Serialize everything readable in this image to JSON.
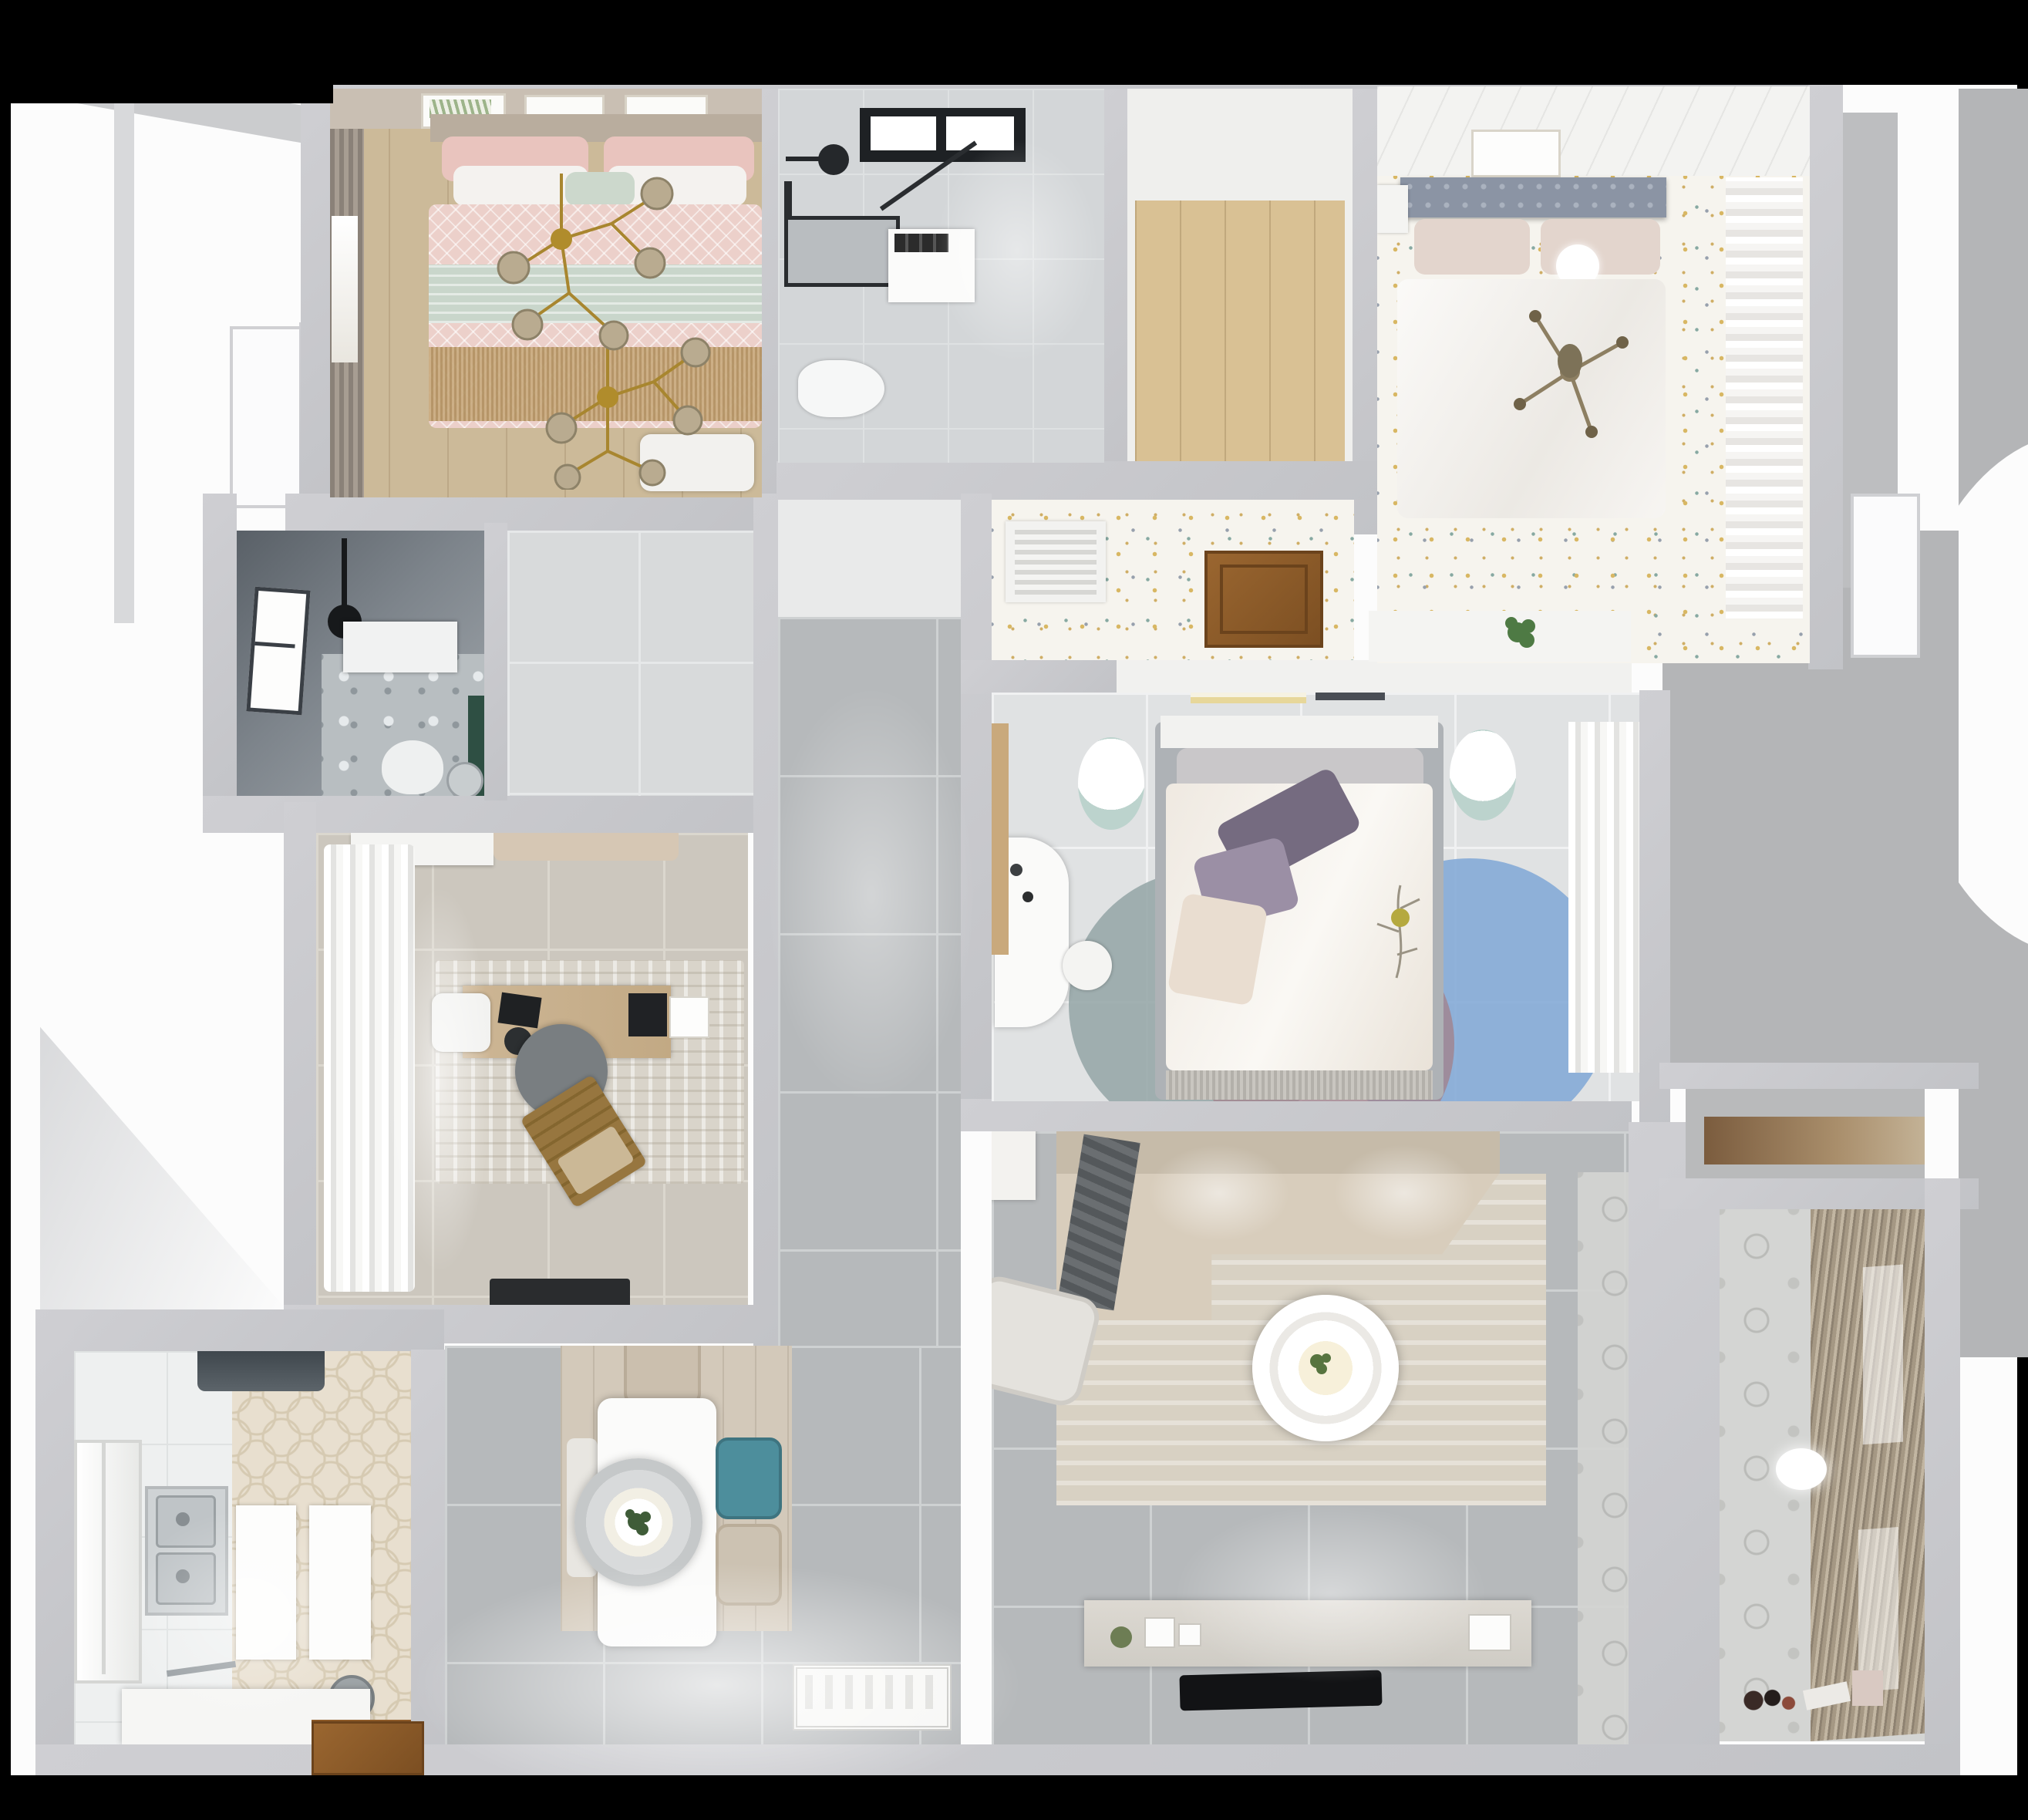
{
  "scene": {
    "title": "Apartment 3D floor plan – top-down render",
    "view": "top-down",
    "background": "#000000"
  },
  "palette": {
    "wall_gray": "#c6c7ca",
    "hall_tile": "#b6b9bb",
    "bedroom3_tile": "#e0e2e3",
    "study_tile": "#ccc7be",
    "kitchen_hex": "#e8dfcf",
    "dotted_floor": "#f6f4ee",
    "wood_floor": "#ccba99",
    "pink_bedding": "#ecd0ca",
    "mint_throw": "#c9d6cb",
    "gold_chandelier": "#a8862f",
    "teal_chair": "#4d8e9c",
    "rug_blue": "#7fa7d6",
    "rug_mauve": "#a2838d",
    "rug_teal": "#93a4a6",
    "door_wood": "#8c5a28",
    "dark_bath": "#596067",
    "sofa_beige": "#d0c5b4",
    "balcony_blind": "#a59884"
  },
  "rooms": {
    "bedroom1": {
      "label": "Bedroom 1 – pink bedding, gold chandelier, wood floor"
    },
    "bathroom1": {
      "label": "Bathroom 1 – skylight, shower, toilet, washer"
    },
    "closet1": {
      "label": "Walk-in closet – wood floor"
    },
    "bedroom2": {
      "label": "Bedroom 2 – white bed, dotted floor, curtain wardrobe"
    },
    "corridor2": {
      "label": "Corridor by bedroom 2 – vent grille, open wood door"
    },
    "bedroom3": {
      "label": "Bedroom 3 – master bed, round rug, desk, closet"
    },
    "livingroom": {
      "label": "Living room – L-sofa, round coffee table, TV wall"
    },
    "balcony": {
      "label": "Balcony – patterned wall, roller blinds, toys"
    },
    "nook": {
      "label": "Storage nook with wood shelf"
    },
    "hallway": {
      "label": "Hallway – gray tiles"
    },
    "vestibule1": {
      "label": "Vestibule by dark bathroom"
    },
    "vestibule2": {
      "label": "Vestibule below bathroom 1"
    },
    "bathroom2": {
      "label": "Dark bathroom – window, shower head, toilet, green vanity"
    },
    "study": {
      "label": "Study – desk, beanbag, wooden lounger, curtains"
    },
    "kitchen": {
      "label": "Kitchen – hex tile, double sink, hood, tub counter"
    },
    "dining": {
      "label": "Dining – white table, pendant lamp, teal chair, entry mat"
    }
  },
  "furniture": {
    "bed1": "Double bed with pink lattice duvet and mint throw",
    "chandelier1": "Gold branch chandelier with glass globes",
    "bed2": "White bed with gray studded headboard",
    "bed3": "Master bed with purple pillows and floral duvet",
    "sofa": "Beige L-shaped sofa with dark throw",
    "coffee_table": "Round white coffee table",
    "tv": "Wall-mounted TV over media console",
    "dining_table": "White rectangular dining table",
    "pendant": "Large round pendant lamp with plant centerpiece",
    "sink": "Stainless double kitchen sink",
    "entry_mat": "Ornamental white entry mat",
    "door_open": "Open wooden interior door"
  }
}
